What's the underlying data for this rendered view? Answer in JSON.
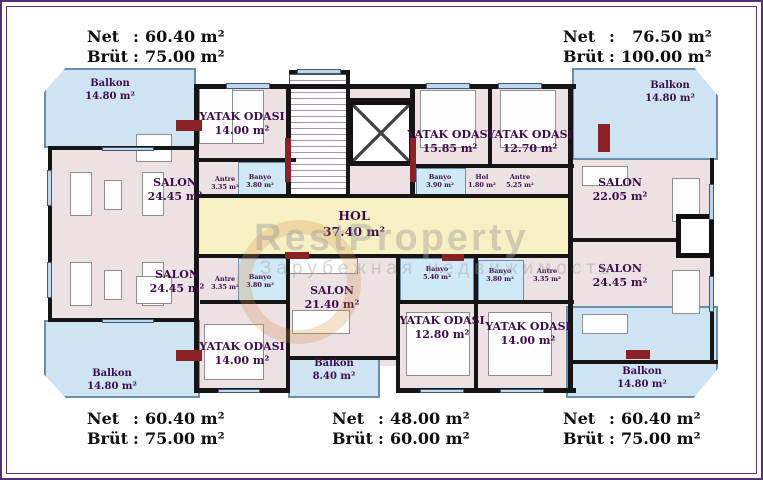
{
  "title": "Apartment block floor plan",
  "colon": ":",
  "summaries": {
    "top_left": {
      "net_label": "Net",
      "net_value": "60.40 m²",
      "brut_label": "Brüt",
      "brut_value": "75.00 m²"
    },
    "top_right": {
      "net_label": "Net",
      "net_value": "76.50 m²",
      "brut_label": "Brüt",
      "brut_value": "100.00 m²"
    },
    "bottom_left": {
      "net_label": "Net",
      "net_value": "60.40 m²",
      "brut_label": "Brüt",
      "brut_value": "75.00 m²"
    },
    "bottom_center": {
      "net_label": "Net",
      "net_value": "48.00 m²",
      "brut_label": "Brüt",
      "brut_value": "60.00 m²"
    },
    "bottom_right": {
      "net_label": "Net",
      "net_value": "60.40 m²",
      "brut_label": "Brüt",
      "brut_value": "75.00 m²"
    }
  },
  "rooms": {
    "tl_balkon": {
      "name": "Balkon",
      "area": "14.80 m²"
    },
    "tl_bedroom": {
      "name": "YATAK ODASI",
      "area": "14.00 m²"
    },
    "tl_salon": {
      "name": "SALON",
      "area": "24.45 m²"
    },
    "tl_antre": {
      "name": "Antre",
      "area": "3.35 m²"
    },
    "tl_banyo": {
      "name": "Banyo",
      "area": "3.80 m²"
    },
    "hol": {
      "name": "HOL",
      "area": "37.40 m²"
    },
    "tr_bedroom1": {
      "name": "YATAK ODASI",
      "area": "15.85 m²"
    },
    "tr_bedroom2": {
      "name": "YATAK ODASI",
      "area": "12.70 m²"
    },
    "tr_banyo": {
      "name": "Banyo",
      "area": "3.90 m²"
    },
    "tr_hol": {
      "name": "Hol",
      "area": "1.80 m²"
    },
    "tr_antre": {
      "name": "Antre",
      "area": "5.25 m²"
    },
    "tr_salon": {
      "name": "SALON",
      "area": "22.05 m²"
    },
    "tr_balkon": {
      "name": "Balkon",
      "area": "14.80 m²"
    },
    "bl_salon": {
      "name": "SALON",
      "area": "24.45 m²"
    },
    "bl_antre": {
      "name": "Antre",
      "area": "3.35 m²"
    },
    "bl_banyo": {
      "name": "Banyo",
      "area": "3.80 m²"
    },
    "bl_bedroom": {
      "name": "YATAK ODASI",
      "area": "14.00 m²"
    },
    "bl_balkon": {
      "name": "Balkon",
      "area": "14.80 m²"
    },
    "bc_salon": {
      "name": "SALON",
      "area": "21.40 m²"
    },
    "bc_banyo": {
      "name": "Banyo",
      "area": "5.40 m²"
    },
    "bc_bedroom": {
      "name": "YATAK ODASI",
      "area": "12.80 m²"
    },
    "bc_balkon": {
      "name": "Balkon",
      "area": "8.40 m²"
    },
    "br_banyo": {
      "name": "Banyo",
      "area": "3.80 m²"
    },
    "br_antre": {
      "name": "Antre",
      "area": "3.35 m²"
    },
    "br_bedroom": {
      "name": "YATAK ODASI",
      "area": "14.00 m²"
    },
    "br_salon": {
      "name": "SALON",
      "area": "24.45 m²"
    },
    "br_balkon": {
      "name": "Balkon",
      "area": "14.80 m²"
    }
  },
  "watermark": {
    "brand": "RestProperty",
    "subtitle": "Зарубежная недвижимость"
  }
}
